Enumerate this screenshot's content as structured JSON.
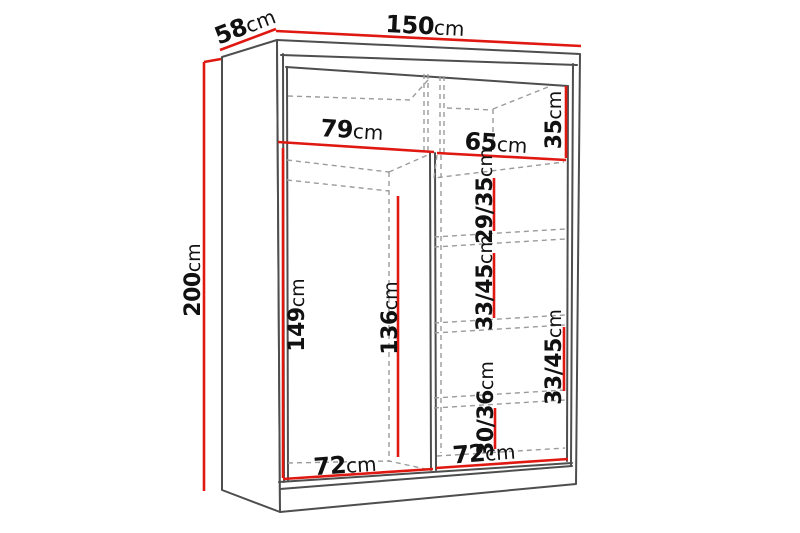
{
  "labels": {
    "width": {
      "num": "150",
      "unit": "cm"
    },
    "depth": {
      "num": "58",
      "unit": "cm"
    },
    "height": {
      "num": "200",
      "unit": "cm"
    },
    "left_section_width": {
      "num": "79",
      "unit": "cm"
    },
    "right_section_width": {
      "num": "65",
      "unit": "cm"
    },
    "top_shelf_height": {
      "num": "35",
      "unit": "cm"
    },
    "shelf_gap_1": {
      "num": "29/35",
      "unit": "cm"
    },
    "shelf_gap_2": {
      "num": "33/45",
      "unit": "cm"
    },
    "shelf_gap_3": {
      "num": "33/45",
      "unit": "cm"
    },
    "shelf_gap_4": {
      "num": "30/36",
      "unit": "cm"
    },
    "hanging_height_front": {
      "num": "149",
      "unit": "cm"
    },
    "hanging_height_back": {
      "num": "136",
      "unit": "cm"
    },
    "left_bottom_width": {
      "num": "72",
      "unit": "cm"
    },
    "right_bottom_width": {
      "num": "72",
      "unit": "cm"
    }
  },
  "colors": {
    "dimension_line": "#e01812",
    "structure_line": "#4e4e4e",
    "dashed_line": "#9b9b9b",
    "background": "#ffffff",
    "label_text": "#111111"
  }
}
